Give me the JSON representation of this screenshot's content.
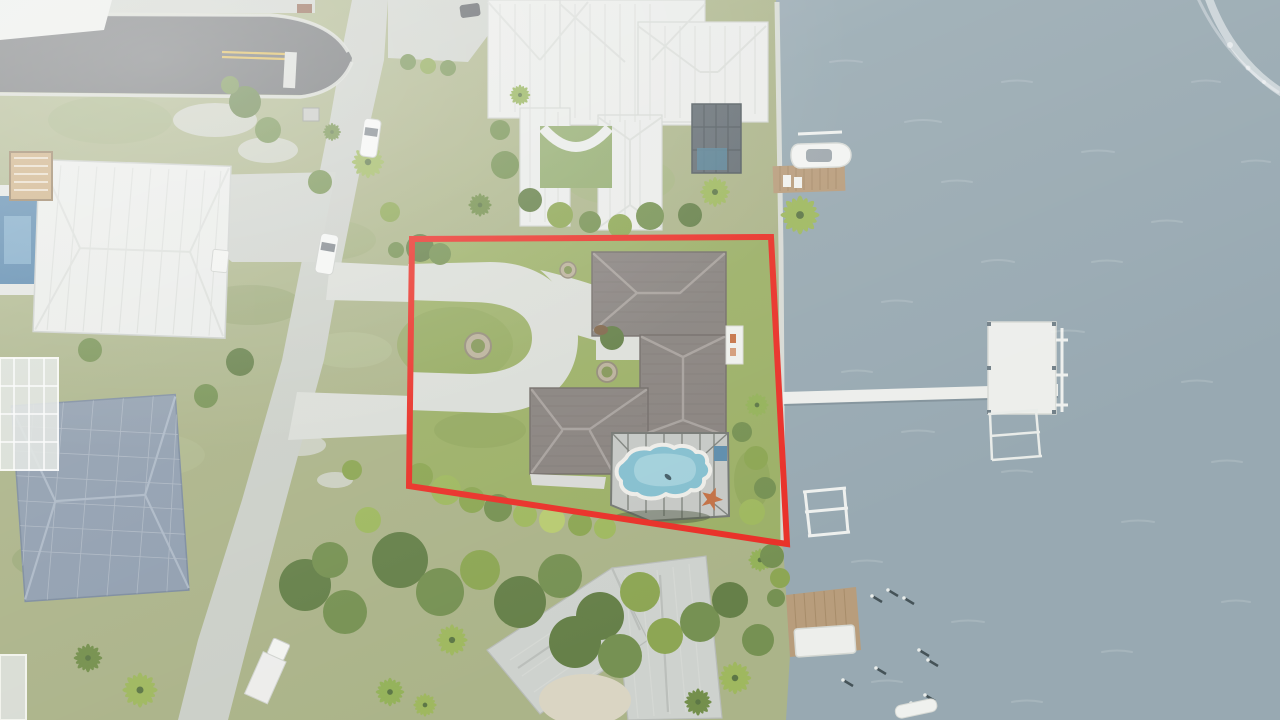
{
  "page": {
    "title": "Aerial drone photo of waterfront property with red lot-line overlay"
  },
  "scene": {
    "type": "aerial-drone-photograph",
    "setting": "waterfront-residential-neighborhood",
    "annotation": {
      "kind": "property-boundary-outline",
      "color": "#e8261d",
      "stroke_width": "6",
      "points": "412,239 771,237 787,544 409,486"
    },
    "subject_property": {
      "features": [
        "dark-shingle-hip-roof-house",
        "circular-driveway",
        "center-island-lawn",
        "stone-planter-rings",
        "entry-courtyard-tree",
        "screened-pool-enclosure",
        "freeform-swimming-pool",
        "starfish-deck-medallion",
        "rear-lawn-to-seawall",
        "tropical-hedge-row"
      ]
    },
    "waterway": {
      "kind": "wide-river-channel",
      "detail": "boat-wake-foam-top-right"
    },
    "docks": [
      "neighbor-dock-north-with-white-boat-on-lift",
      "long-private-pier-with-large-platform",
      "boat-lift-frames",
      "wood-dock-south",
      "white-floating-dock-south",
      "mooring-pilings"
    ],
    "streets": [
      "dark-asphalt-road-west",
      "concrete-street-curving-south",
      "double-yellow-center-stripe"
    ],
    "vehicles": [
      "white-car-on-street-north",
      "white-car-on-street-mid",
      "white-box-truck-south",
      "dark-car-estate-driveway",
      "white-van-neighbor-driveway",
      "small-white-boat-bottom"
    ],
    "neighbor_houses": [
      "estate-white-metal-roof-north-with-screened-lanai-and-courtyard",
      "house-white-metal-roof-west-with-pool-and-roof-deck",
      "house-blue-gray-shingle-roof-southwest-with-screen-enclosures",
      "house-gray-metal-roof-south",
      "partial-white-roof-northwest"
    ]
  },
  "colors": {
    "water": "#93a5ae",
    "land": "#a7b083",
    "lot_lawn": "#97ac60",
    "asphalt": "#66696b",
    "road_concrete": "#c9cdc6",
    "driveway_concrete": "#d9dcd6",
    "curb": "#d8dbd5",
    "stripe_yellow": "#d9b44a",
    "roof_white": "#e9ebe8",
    "roof_subject": "#837d79",
    "roof_blue_gray": "#8b9aab",
    "roof_south_gray": "#ccd0cc",
    "lanai_paver": "#c3c6c2",
    "lanai_screen_dark": "#5d676d",
    "pool_water": "#7fbccd",
    "pool_light": "#abd6e0",
    "pool_dark_neighbor": "#4a7da5",
    "wood_dock": "#b59875",
    "white_dock": "#eceeea",
    "boundary_red": "#e8261d",
    "starfish_orange": "#c06a3c",
    "roof_deck_wood": "#c9a877",
    "sand": "#d9d3c0"
  }
}
